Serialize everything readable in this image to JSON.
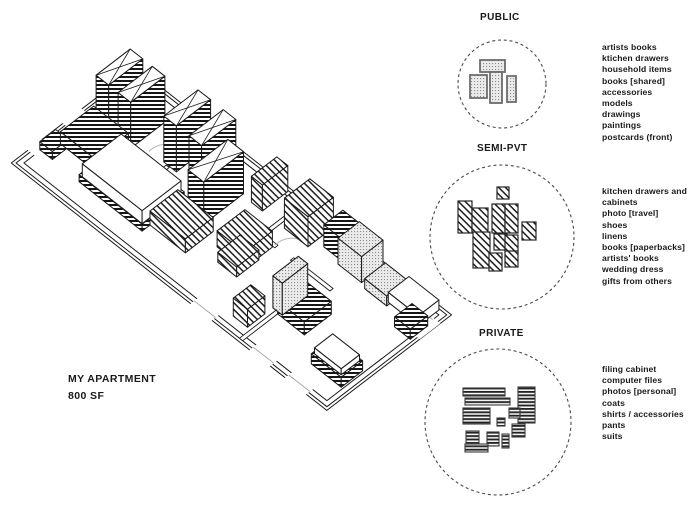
{
  "plan": {
    "title": "MY APARTMENT",
    "area": "800 SF"
  },
  "legend": {
    "public_pattern": "dotted-grid",
    "semi_pvt_pattern": "diagonal-hatch",
    "private_pattern": "horizontal-stripes",
    "public_fill": "#e9e9e9",
    "line_color": "#1a1a1a"
  },
  "sections": [
    {
      "id": "public",
      "label": "PUBLIC",
      "items": [
        "artists books",
        "ktichen drawers",
        "household items",
        "books [shared]",
        "accessories",
        "models",
        "drawings",
        "paintings",
        "postcards (front)"
      ]
    },
    {
      "id": "semi_pvt",
      "label": "SEMI-PVT",
      "items": [
        "kitchen drawers and",
        "cabinets",
        "photo [travel]",
        "shoes",
        "linens",
        "books [paperbacks]",
        "artists' books",
        "wedding dress",
        "gifts from others"
      ]
    },
    {
      "id": "private",
      "label": "PRIVATE",
      "items": [
        "filing cabinet",
        "computer files",
        "photos [personal]",
        "coats",
        "shirts / accessories",
        "pants",
        "suits"
      ]
    }
  ]
}
